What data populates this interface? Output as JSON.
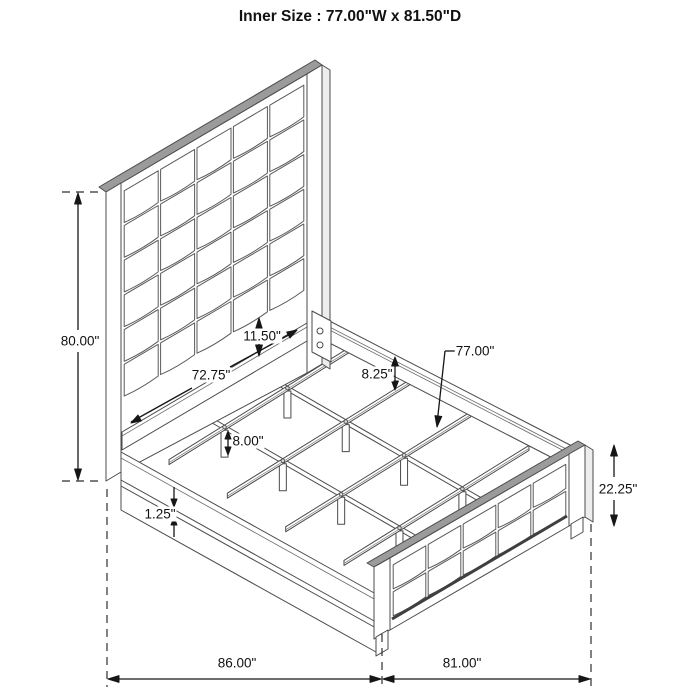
{
  "title": "Inner Size : 77.00\"W x 81.50\"D",
  "dimensions": {
    "overall_height": "80.00\"",
    "headboard_lower_section": "11.50\"",
    "headboard_inner_width": "72.75\"",
    "rail_above_slat": "8.25\"",
    "slat_length": "77.00\"",
    "slat_leg_height": "8.00\"",
    "rail_trim_thickness": "1.25\"",
    "footboard_height": "22.25\"",
    "overall_depth": "86.00\"",
    "overall_width": "81.00\""
  }
}
